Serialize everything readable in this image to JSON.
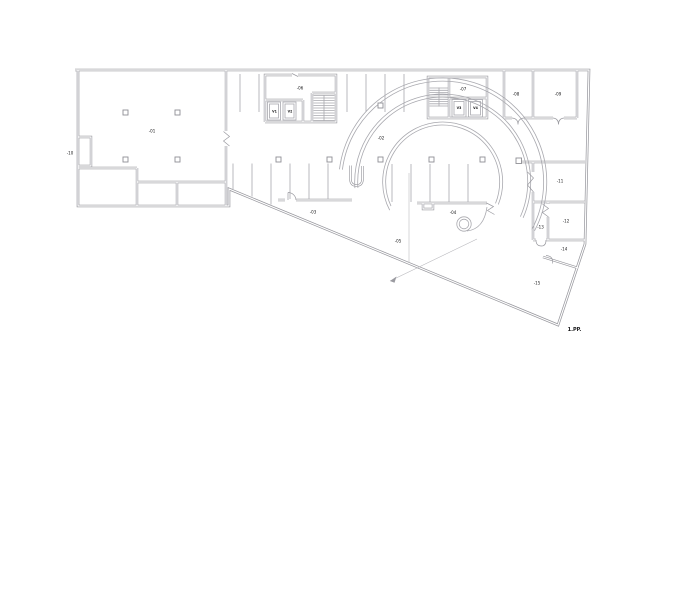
{
  "drawing": {
    "title": "1.PP.",
    "colors": {
      "wall": "#97979d",
      "line": "#a9a9af",
      "label": "#141416",
      "background": "#ffffff"
    },
    "labels": {
      "hall": "-01",
      "store": "-10",
      "garage": "-02",
      "ramp_zone": "-03",
      "lane": "-04",
      "ramp": "-05",
      "stair_west": "-06",
      "lift_w1": "V1",
      "lift_w2": "V2",
      "stair_east": "-07",
      "lift_e1": "V3",
      "lift_e2": "V4",
      "room_ne1": "-08",
      "room_ne2": "-09",
      "room_e1": "-11",
      "room_e2": "-12",
      "lobby": "-13",
      "entry": "-14",
      "yard": "-15"
    }
  }
}
